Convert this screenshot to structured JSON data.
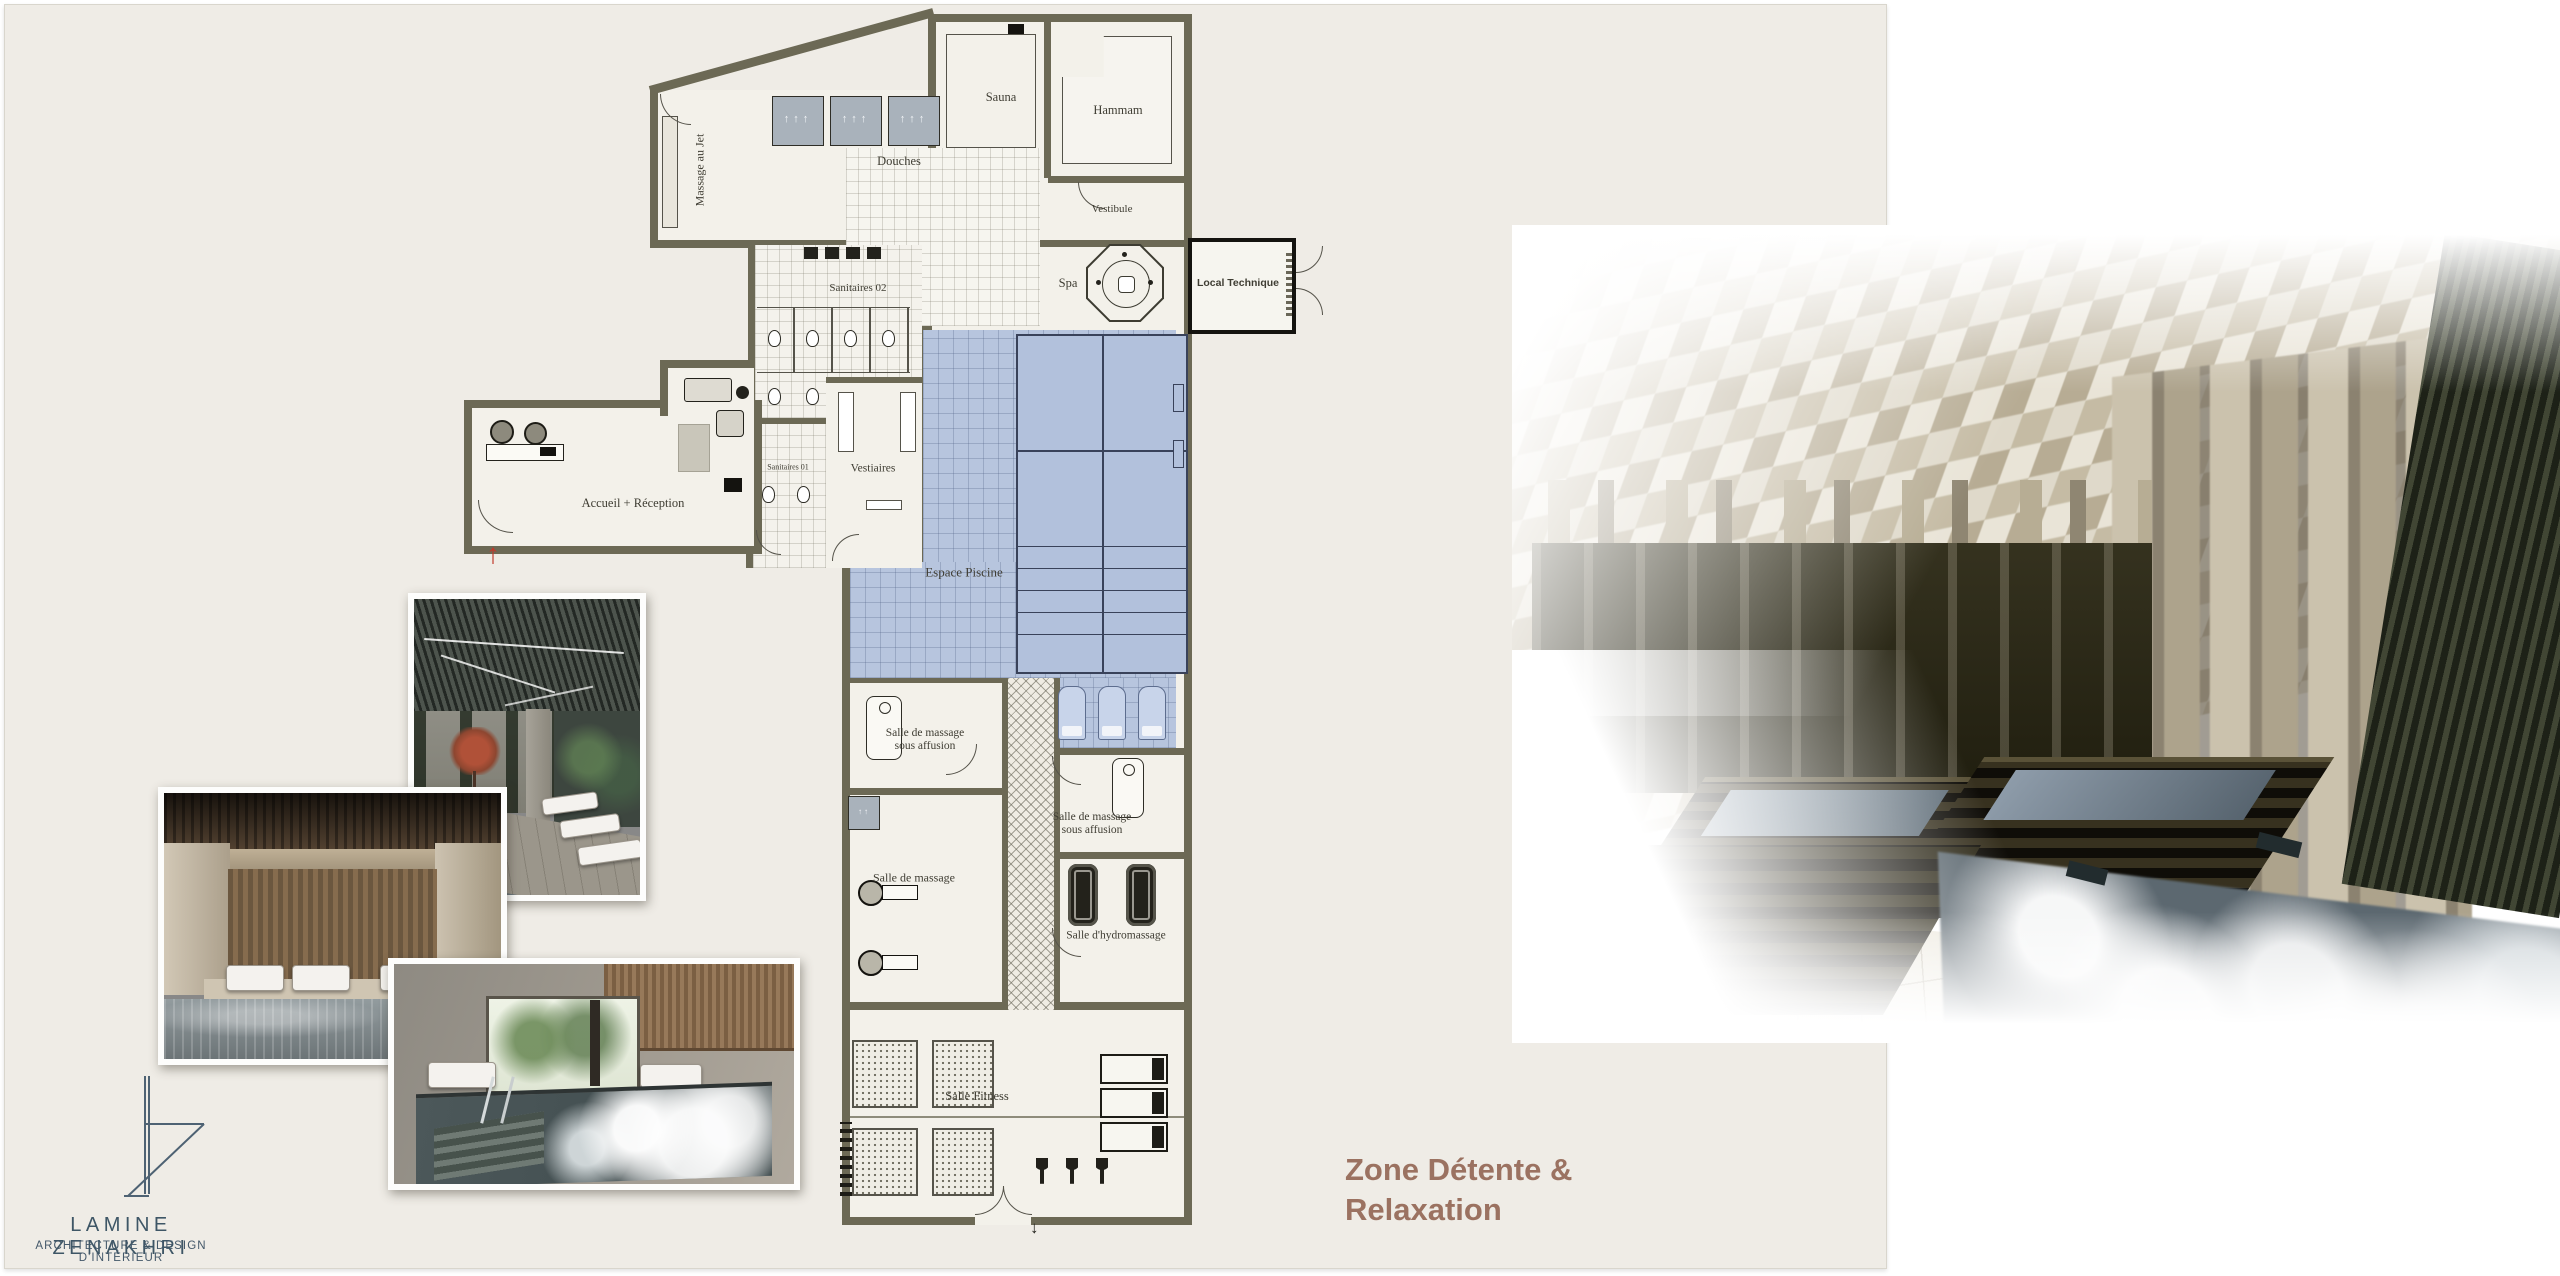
{
  "slide": {
    "title": {
      "line1": "Zone Détente &",
      "line2": "Relaxation"
    }
  },
  "logo": {
    "name": "LAMINE  ZENAKHRI",
    "tagline": "ARCHITECTURE & DESIGN D'INTÉRIEUR"
  },
  "floor_plan": {
    "rooms": {
      "massage_au_jet": "Massage au Jet",
      "douches": "Douches",
      "sauna": "Sauna",
      "hammam": "Hammam",
      "vestibule": "Vestibule",
      "spa": "Spa",
      "local_technique": "Local Technique",
      "sanitaires_02": "Sanitaires 02",
      "sanitaires_01": "Sanitaires 01",
      "vestiaires": "Vestiaires",
      "accueil_reception": "Accueil + Réception",
      "espace_piscine": "Espace Piscine",
      "massage_affusion_1": "Salle de massage sous affusion",
      "massage_affusion_2": "Salle de massage sous affusion",
      "salle_de_massage": "Salle de massage",
      "hydromassage": "Salle d'hydromassage",
      "salle_fitness": "Salle Fitness"
    }
  },
  "colors": {
    "slide_background": "#efece6",
    "wall": "#6c6955",
    "pool_blue": "#b7c5de",
    "title_accent": "#9b7261",
    "logo_blue": "#3e5666",
    "entrance_arrow_red": "#c0392b"
  }
}
